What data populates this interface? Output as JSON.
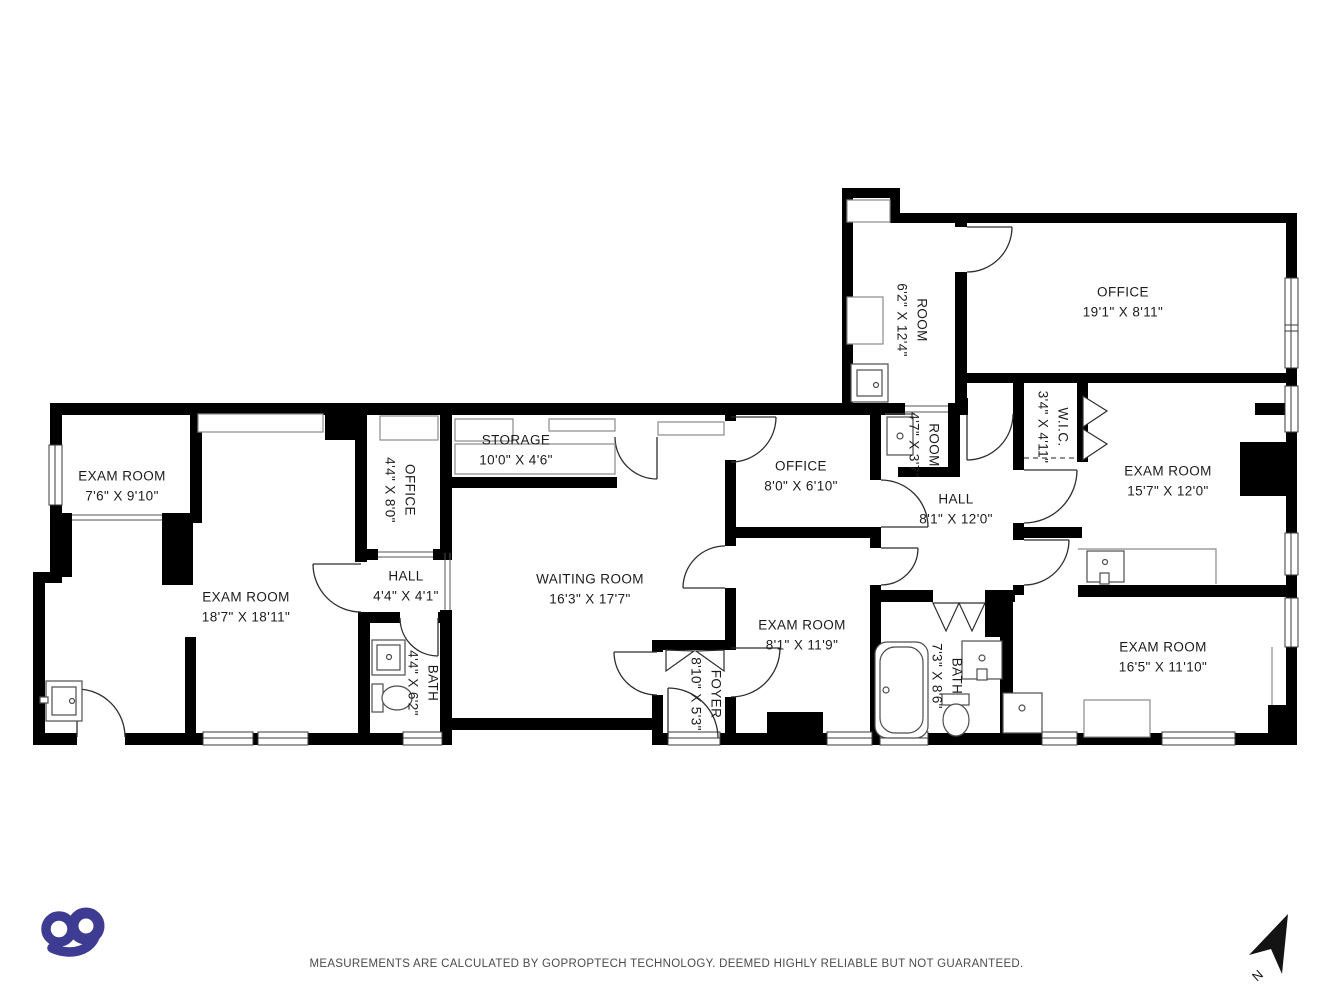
{
  "meta": {
    "background": "#ffffff",
    "wall_color": "#000000",
    "logo_color": "#3e3c92"
  },
  "branding": {
    "logo_text": "go"
  },
  "compass": {
    "label": "N"
  },
  "footer": {
    "disclaimer": "MEASUREMENTS ARE CALCULATED BY GOPROPTECH TECHNOLOGY. DEEMED HIGHLY RELIABLE BUT NOT GUARANTEED."
  },
  "rooms": [
    {
      "id": "exam-room-7-6",
      "name": "EXAM ROOM",
      "dims": "7'6\" X 9'10\""
    },
    {
      "id": "exam-room-18-7",
      "name": "EXAM ROOM",
      "dims": "18'7\" X 18'11\""
    },
    {
      "id": "office-4-4",
      "name": "OFFICE",
      "dims": "4'4\" X 8'0\""
    },
    {
      "id": "hall-4-4",
      "name": "HALL",
      "dims": "4'4\" X 4'1\""
    },
    {
      "id": "bath-4-4",
      "name": "BATH",
      "dims": "4'4\" X 6'2\""
    },
    {
      "id": "storage",
      "name": "STORAGE",
      "dims": "10'0\" X 4'6\""
    },
    {
      "id": "waiting-room",
      "name": "WAITING ROOM",
      "dims": "16'3\" X 17'7\""
    },
    {
      "id": "foyer",
      "name": "FOYER",
      "dims": "8'10\" X 5'3\""
    },
    {
      "id": "office-8-0",
      "name": "OFFICE",
      "dims": "8'0\" X 6'10\""
    },
    {
      "id": "exam-room-8-1",
      "name": "EXAM ROOM",
      "dims": "8'1\" X 11'9\""
    },
    {
      "id": "room-4-7",
      "name": "ROOM",
      "dims": "4'7\" X 3'7\""
    },
    {
      "id": "hall-8-1",
      "name": "HALL",
      "dims": "8'1\" X 12'0\""
    },
    {
      "id": "room-6-2",
      "name": "ROOM",
      "dims": "6'2\" X 12'4\""
    },
    {
      "id": "office-19-1",
      "name": "OFFICE",
      "dims": "19'1\" X 8'11\""
    },
    {
      "id": "wic",
      "name": "W.I.C.",
      "dims": "3'4\" X 4'11\""
    },
    {
      "id": "exam-room-15-7",
      "name": "EXAM ROOM",
      "dims": "15'7\" X 12'0\""
    },
    {
      "id": "bath-7-3",
      "name": "BATH",
      "dims": "7'3\" X 8'6\""
    },
    {
      "id": "exam-room-16-5",
      "name": "EXAM ROOM",
      "dims": "16'5\" X 11'10\""
    }
  ]
}
